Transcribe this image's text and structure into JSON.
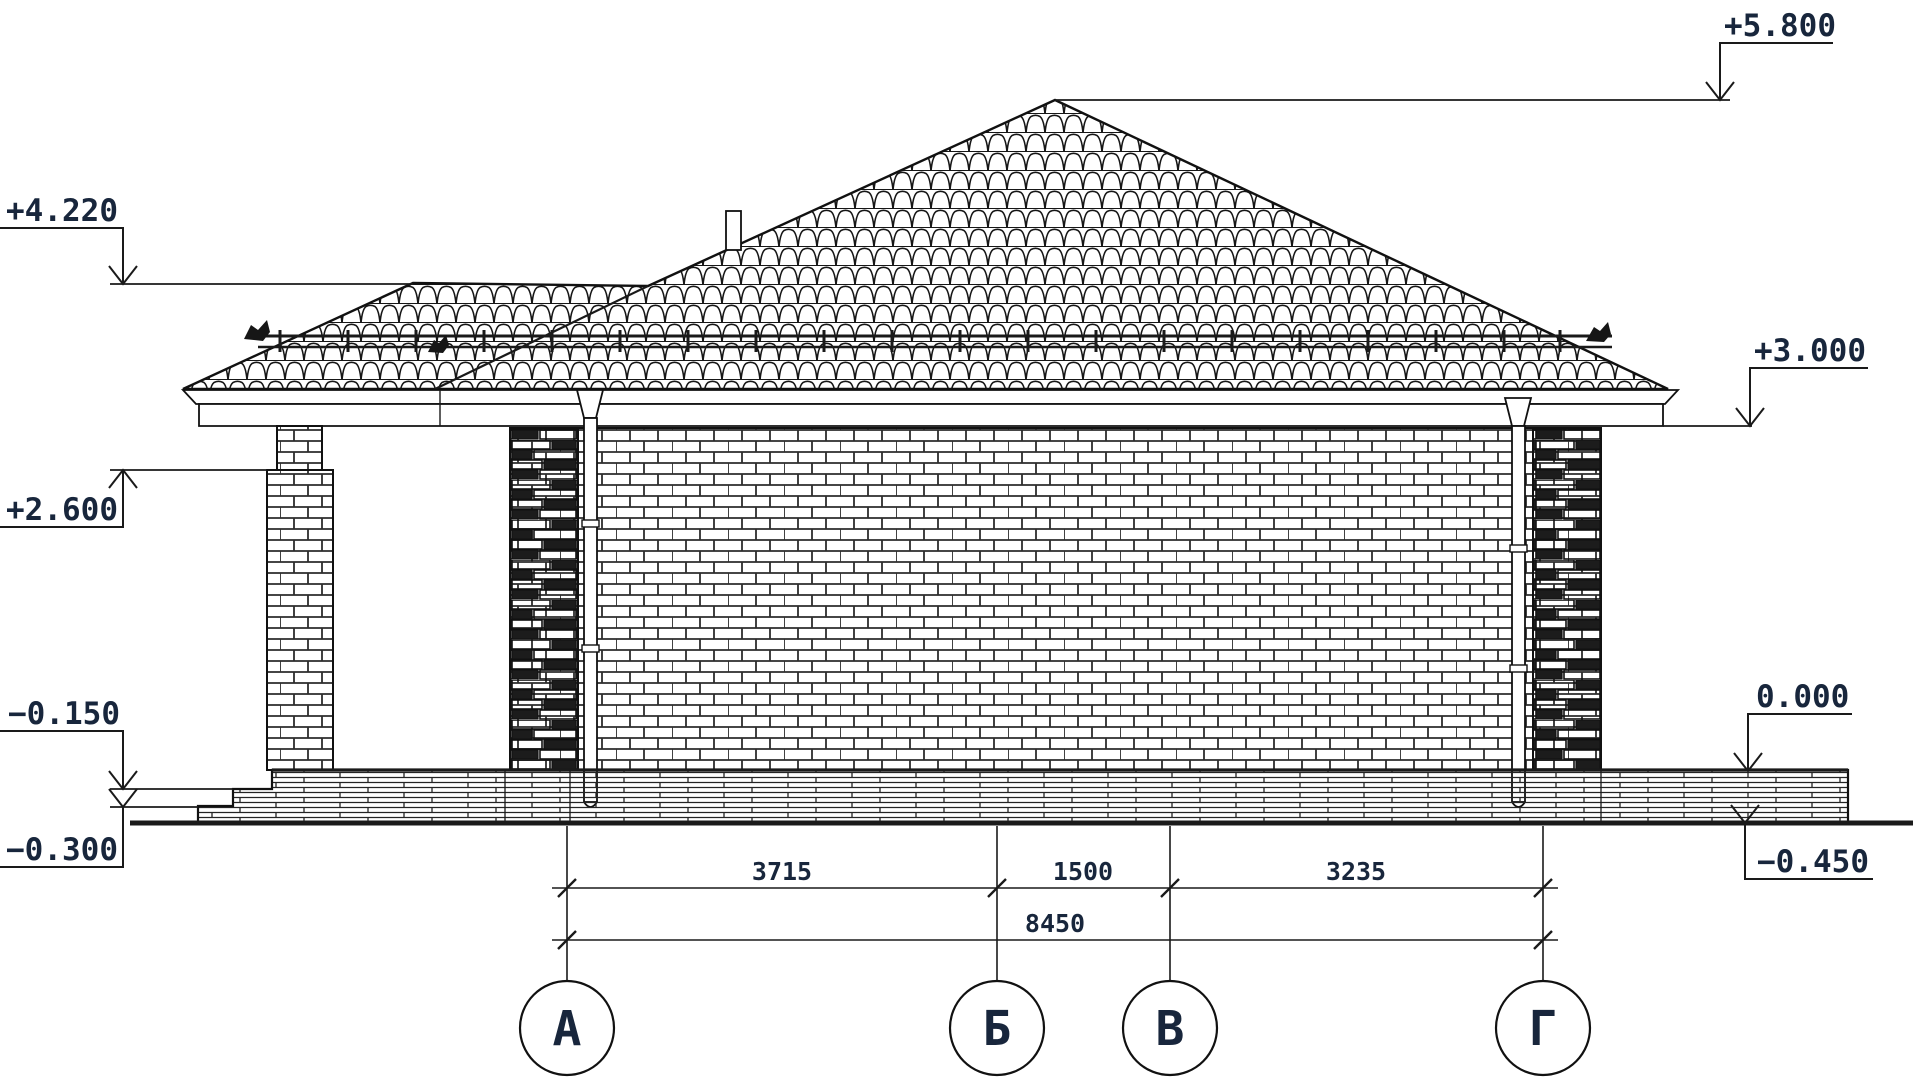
{
  "drawing": {
    "elevation_marks": {
      "roof_peak": "+5.800",
      "porch_ridge": "+4.220",
      "eaves": "+3.000",
      "porch_beam": "+2.600",
      "porch_floor": "−0.150",
      "floor_zero": "0.000",
      "porch_base": "−0.300",
      "ground": "−0.450"
    },
    "dimensions": {
      "span_a_b": "3715",
      "span_b_v": "1500",
      "span_v_g": "3235",
      "total": "8450"
    },
    "axes": {
      "a": "А",
      "b": "Б",
      "v": "В",
      "g": "Г"
    },
    "colors": {
      "line": "#1a1a1a",
      "text": "#18263c",
      "fill_dark": "#161616",
      "background": "#ffffff"
    }
  }
}
